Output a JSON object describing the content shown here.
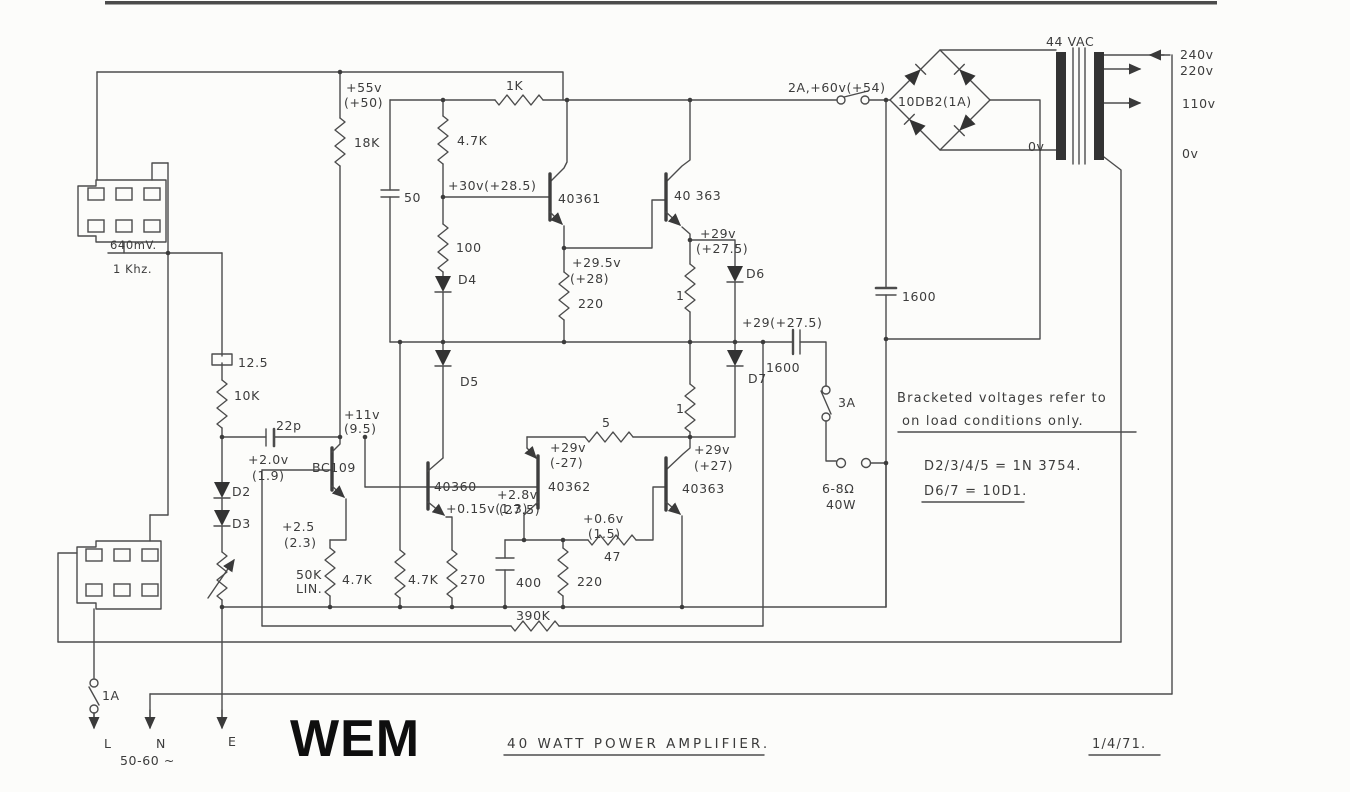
{
  "meta": {
    "brand": "WEM",
    "title": "40 WATT  POWER  AMPLIFIER.",
    "date": "1/4/71."
  },
  "notes": {
    "l1": "Bracketed voltages refer to",
    "l2": "on load conditions only.",
    "d_eq1": "D2/3/4/5 = 1N 3754.",
    "d_eq2": "D6/7 = 10D1."
  },
  "psu": {
    "fuse_2a": "2A,+60v(+54)",
    "bridge": "10DB2(1A)",
    "vac": "44 VAC",
    "tap_240": "240v",
    "tap_220": "220v",
    "tap_110": "110v",
    "tap_0": "0v",
    "sec_0": "0v",
    "rail_55": "+55v",
    "rail_55b": "(+50)",
    "cap_res": "1600",
    "cap_out": "1600",
    "fuse_3a": "3A",
    "out_load": "6-8Ω",
    "out_power": "40W",
    "fuse_1a": "1A",
    "live": "L",
    "neutral": "N",
    "earth": "E",
    "mains_hz": "50-60 ~"
  },
  "io": {
    "level": "640mV.",
    "freq": "1 Khz."
  },
  "parts": {
    "r18k": "18K",
    "r1k": "1K",
    "r47k_top": "4.7K",
    "r100": "100",
    "r220_top": "220",
    "r1a": "1",
    "r1b": "1",
    "r5": "5",
    "r47": "47",
    "r47k_a": "4.7K",
    "r47k_b": "4.7K",
    "r270": "270",
    "r220_bot": "220",
    "r390k": "390K",
    "r10k": "10K",
    "pot": "50K",
    "pot_b": "LIN.",
    "c50": "50",
    "c400": "400",
    "c125": "12.5",
    "c22p": "22p",
    "d2": "D2",
    "d3": "D3",
    "d4": "D4",
    "d5": "D5",
    "d6": "D6",
    "d7": "D7",
    "q_bc109": "BC109",
    "q40360": "40360",
    "q40361": "40361",
    "q40362": "40362",
    "q40363_top": "40 363",
    "q40363_bot": "40363"
  },
  "volts": {
    "v30": "+30v(+28.5)",
    "v295": "+29.5v",
    "v295b": "(+28)",
    "v29a": "+29v",
    "v29ab": "(+27.5)",
    "v29x": "+29(+27.5)",
    "v29c": "+29v",
    "v29cb": "(-27)",
    "v29d": "+29v",
    "v29db": "(+27)",
    "v28": "+2.8v",
    "v28b": "(27.5)",
    "v06": "+0.6v",
    "v06b": "(1.5)",
    "v015": "+0.15v(1.3)",
    "v11": "+11v",
    "v11b": "(9.5)",
    "v20": "+2.0v",
    "v20b": "(1.9)",
    "v25": "+2.5",
    "v25b": "(2.3)"
  }
}
